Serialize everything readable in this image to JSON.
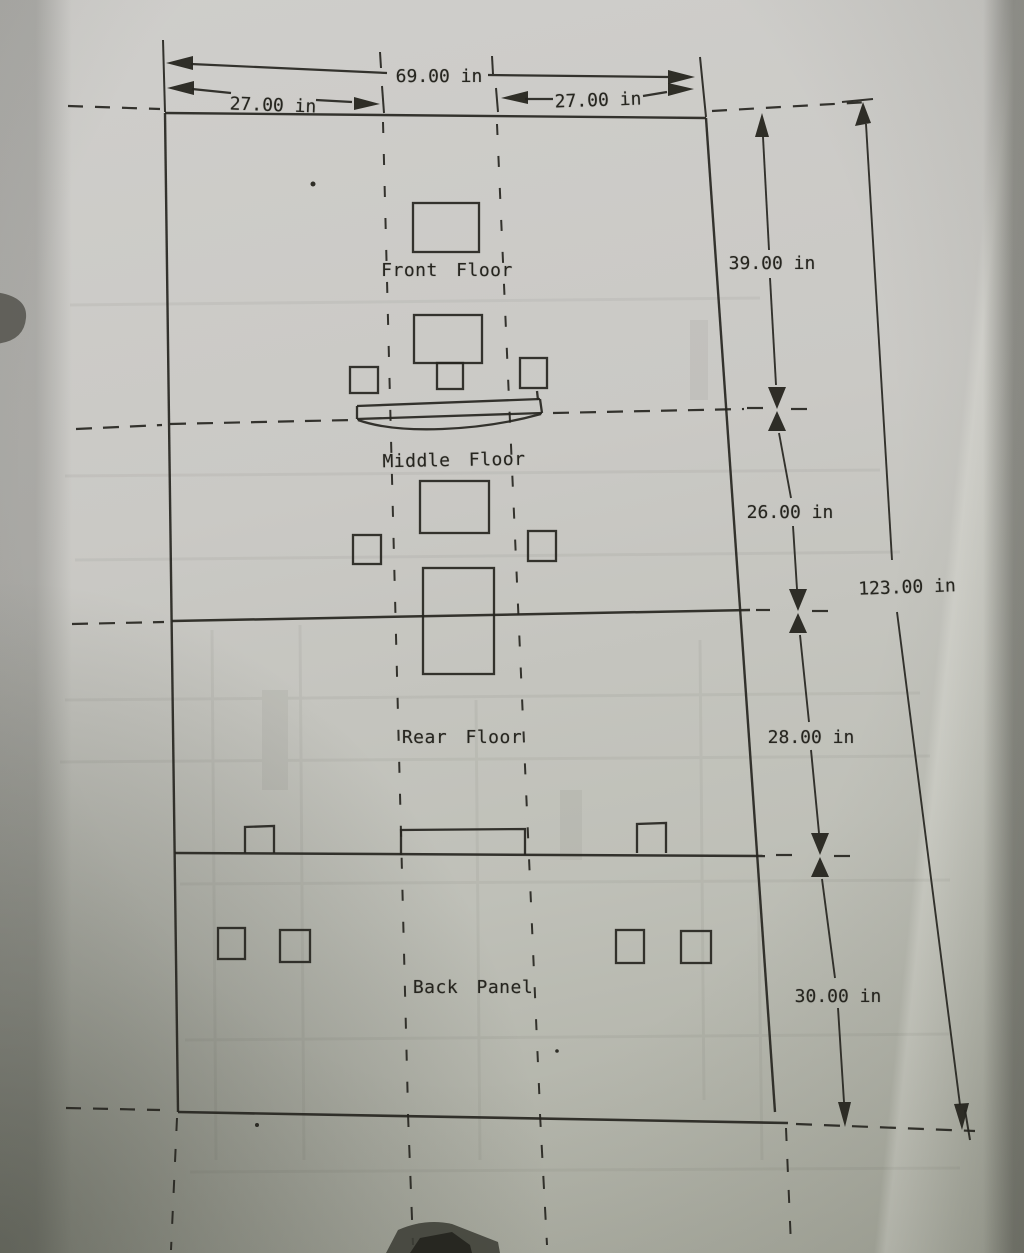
{
  "drawing": {
    "panel_labels": {
      "front": "Front Floor",
      "middle": "Middle Floor",
      "rear": "Rear Floor",
      "back": "Back Panel"
    },
    "dimensions": {
      "total_width": "69.00 in",
      "left_offset": "27.00 in",
      "right_offset": "27.00 in",
      "front_floor_height": "39.00 in",
      "middle_floor_height": "26.00 in",
      "rear_floor_height": "28.00 in",
      "back_panel_height": "30.00 in",
      "total_height": "123.00 in"
    }
  },
  "colors": {
    "paper": "#c9c8c4",
    "paper_shadow": "#a8aa9f",
    "ink": "#26251f"
  }
}
